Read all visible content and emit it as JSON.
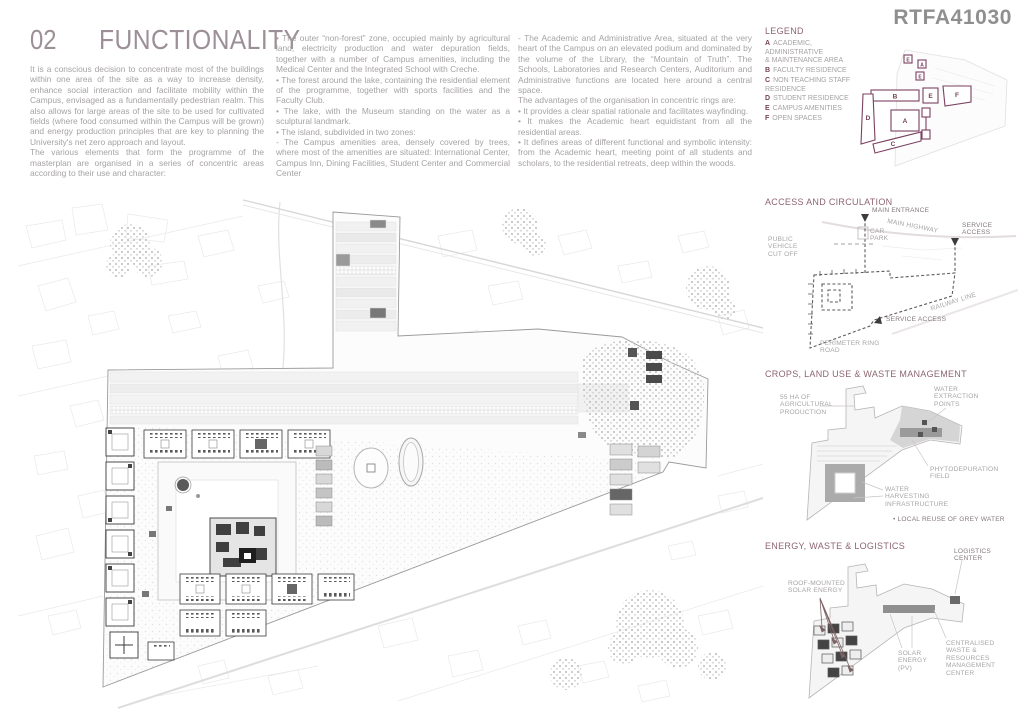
{
  "board_code": "RTFA41030",
  "colors": {
    "title": "#9c8f97",
    "section_heading": "#8d6670",
    "legend_accent": "#74405a",
    "body_text": "#a6a2a4",
    "code_gray": "#8f8f8f"
  },
  "header": {
    "number": "02",
    "title": "FUNCTIONALITY",
    "col1": [
      "It is a conscious decision to concentrate most of the buildings within one area of the site as a way to increase density, enhance social interaction and facilitate mobility within the Campus, envisaged as a fundamentally pedestrian realm. This also allows for large areas of the site to be used for cultivated fields (where food consumed within the Campus will be grown) and energy production principles that are key to planning the University's net zero approach and layout.",
      "The various elements that form the programme of the masterplan are organised in a series of concentric areas according to their use and character:"
    ],
    "col2": [
      "• The outer “non-forest” zone, occupied mainly by agricultural land, electricity production and water depuration fields, together with a number of Campus amenities, including the Medical Center and the Integrated School with Creche.",
      "• The forest around the lake, containing the residential element of the programme, together with sports facilities and the Faculty Club.",
      "• The lake, with the Museum standing on the water as a sculptural landmark.",
      "• The island, subdivided in two zones:",
      "- The Campus amenities area, densely covered by trees, where most of the amenities are situated: International Center, Campus Inn, Dining Facilities, Student Center and Commercial Center"
    ],
    "col3": [
      "- The Academic and Administrative Area, situated at the very heart of the Campus on an elevated podium and dominated by the volume of the Library, the “Mountain of Truth”. The Schools, Laboratories and Research Centers, Auditorium and Administrative functions are located here around a central space.",
      "The advantages of the organisation in concentric rings are:",
      "• It provides a clear spatial rationale and facilitates wayfinding.",
      "• It makes the Academic heart equidistant from all the residential areas.",
      "• It defines areas of different functional and symbolic intensity: from the Academic heart, meeting point of all students and scholars, to the residential retreats, deep within the woods."
    ]
  },
  "legend": {
    "heading": "LEGEND",
    "items": [
      {
        "key": "A",
        "label": "ACADEMIC, ADMINISTRATIVE\n& MAINTENANCE AREA"
      },
      {
        "key": "B",
        "label": "FACULTY RESIDENCE"
      },
      {
        "key": "C",
        "label": "NON TEACHING STAFF\nRESIDENCE"
      },
      {
        "key": "D",
        "label": "STUDENT RESIDENCE"
      },
      {
        "key": "E",
        "label": "CAMPUS AMENITIES"
      },
      {
        "key": "F",
        "label": "OPEN SPACES"
      }
    ]
  },
  "sections": {
    "access": {
      "heading": "ACCESS AND CIRCULATION",
      "labels": {
        "main_entrance": "MAIN ENTRANCE",
        "main_highway": "MAIN HIGHWAY",
        "service_access_top": "SERVICE\nACCESS",
        "car_park": "CAR\nPARK",
        "public_cutoff": "PUBLIC\nVEHICLE\nCUT OFF",
        "railway_line": "RAILWAY LINE",
        "service_access_mid": "SERVICE ACCESS",
        "perimeter_ring": "PERIMETER RING\nROAD"
      }
    },
    "crops": {
      "heading": "CROPS, LAND USE & WASTE MANAGEMENT",
      "labels": {
        "agricultural": "55 HA OF\nAGRICULTURAL\nPRODUCTION",
        "water_extraction": "WATER\nEXTRACTION\nPOINTS",
        "phytodepuration": "PHYTODEPURATION\nFIELD",
        "water_harvesting": "WATER\nHARVESTING\nINFRASTRUCTURE",
        "grey_water": "• LOCAL REUSE OF GREY WATER"
      }
    },
    "energy": {
      "heading": "ENERGY, WASTE & LOGISTICS",
      "labels": {
        "logistics": "LOGISTICS\nCENTER",
        "roof_solar": "ROOF-MOUNTED\nSOLAR ENERGY",
        "solar_pv": "SOLAR\nENERGY\n(PV)",
        "waste_center": "CENTRALISED\nWASTE &\nRESOURCES\nMANAGEMENT\nCENTER"
      }
    }
  }
}
